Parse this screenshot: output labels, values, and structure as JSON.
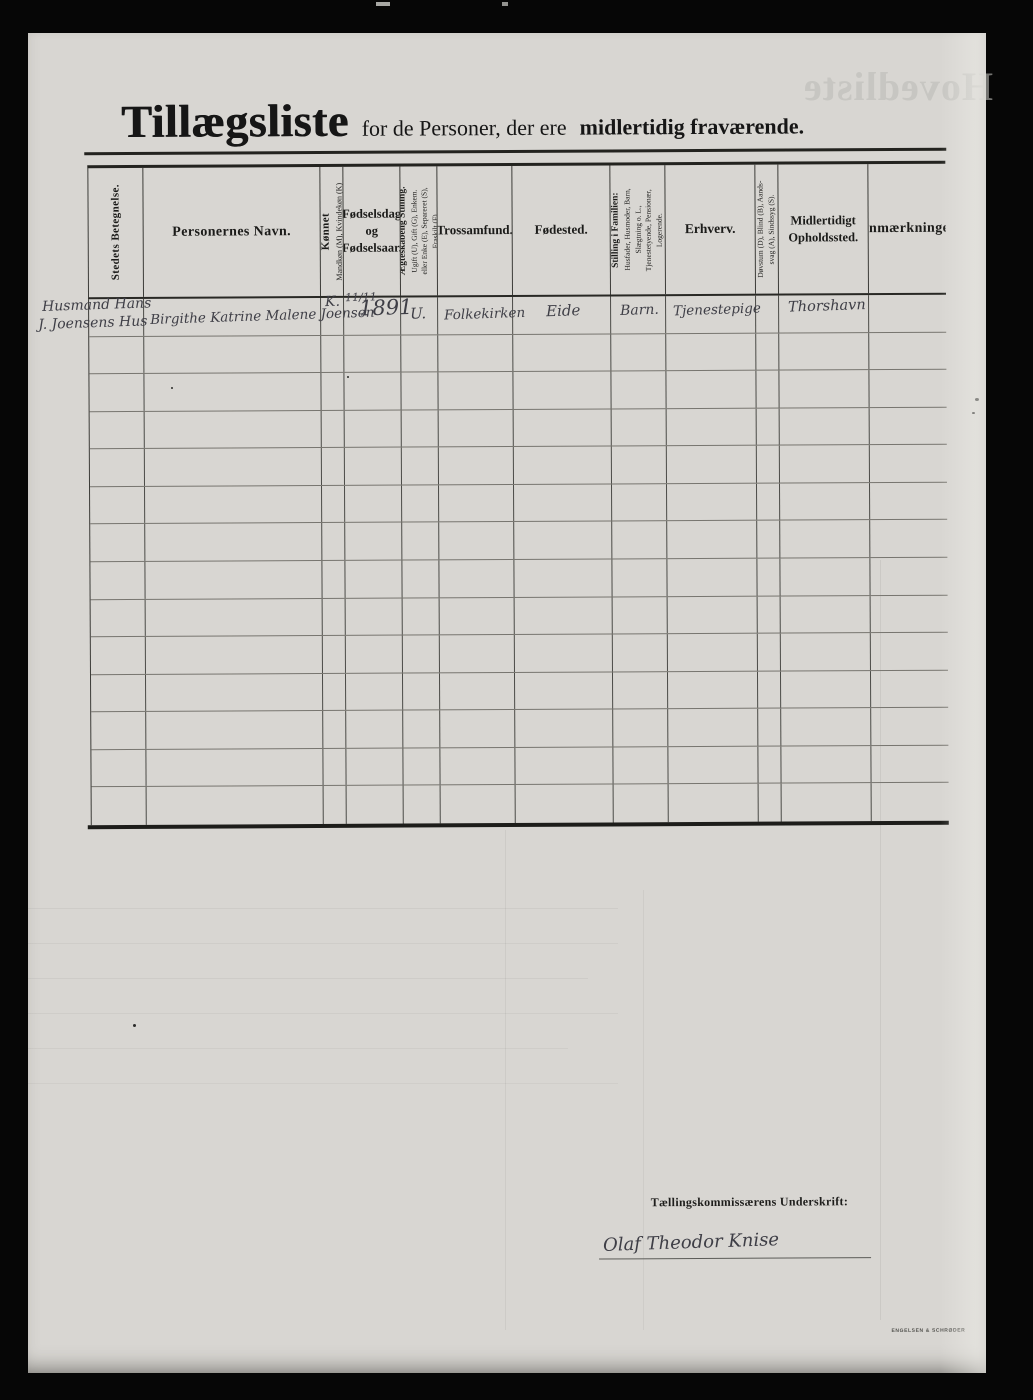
{
  "document": {
    "title": {
      "main": "Tillægsliste",
      "subtitle_regular": "for de Personer, der ere",
      "subtitle_bold": "midlertidig fraværende."
    },
    "ghost_bleedthrough_text": "Hovedliste",
    "printers_mark": "ENGELSEN & SCHRØDER"
  },
  "table": {
    "row_count": 14,
    "headers": {
      "stedets_betegnelse": "Stedets Betegnelse.",
      "personernes_navn": "Personernes Navn.",
      "koennet": [
        "Kønnet",
        "Mandkøn (M), Kvindekøn (K)"
      ],
      "foedselsdag": "Fødselsdag og Fødselsaar.",
      "aegteskabelig": [
        "Ægteskabelig Stilling.",
        "Ugift (U), Gift (G), Enkem.",
        "eller Enke (E), Separeret (S),",
        "Fraskilt (F)"
      ],
      "trossamfund": "Trossamfund.",
      "foedested": "Fødested.",
      "stilling_i_familien": [
        "Stilling i Familien:",
        "Husfader, Husmoder, Barn,",
        "Slægtning o. L.,",
        "Tjenestetyende, Pensionær,",
        "Logerende."
      ],
      "erhverv": "Erhverv.",
      "doevstum": [
        "Døvstum (D), Blind (B), Aands-",
        "svag (A), Sindssyg (S)."
      ],
      "midlertidigt_opholdssted": "Midlertidigt Opholdssted.",
      "anmaerkninger": "Anmærkninger"
    },
    "entry": {
      "stedets_betegnelse_line1": "Husmand Hans",
      "stedets_betegnelse_line2": "J. Joensens Hus",
      "navn": "Birgithe Katrine Malene Joensen",
      "koennet": "K.",
      "foedselsdag_dato": "11/11",
      "foedselsaar": "1891",
      "aegteskabelig_stilling": "U.",
      "trossamfund": "Folkekirken",
      "foedested": "Eide",
      "stilling_i_familien": "Barn.",
      "erhverv": "Tjenestepige",
      "doevstum": "",
      "midlertidigt_opholdssted": "Thorshavn",
      "anmaerkninger": ""
    }
  },
  "signature": {
    "label": "Tællingskommissærens Underskrift:",
    "name": "Olaf Theodor Knise"
  }
}
